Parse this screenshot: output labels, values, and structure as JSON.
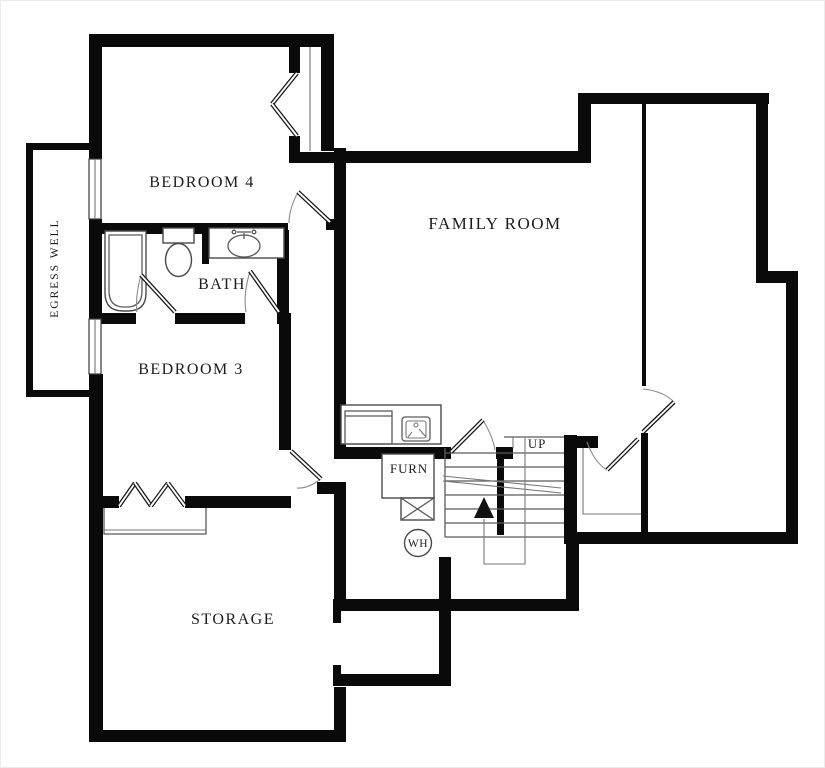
{
  "plan": {
    "type": "basement-floor-plan",
    "colors": {
      "wall": "#0a0a0a",
      "fixture_line": "#4a4a4a",
      "text": "#1c1c1c",
      "background": "#ffffff"
    },
    "rooms": {
      "bedroom4": {
        "label": "BEDROOM 4"
      },
      "bedroom3": {
        "label": "BEDROOM 3"
      },
      "bath": {
        "label": "BATH"
      },
      "family_room": {
        "label": "FAMILY ROOM"
      },
      "storage": {
        "label": "STORAGE"
      },
      "egress_well": {
        "label": "EGRESS WELL"
      }
    },
    "annotations": {
      "furnace": {
        "label": "FURN"
      },
      "water_heater": {
        "label": "WH"
      },
      "stairs_up": {
        "label": "UP"
      }
    },
    "fixtures": [
      "bathtub",
      "toilet",
      "vanity-sink",
      "washer",
      "utility-sink",
      "furnace-box",
      "water-heater-circle",
      "stairs-switchback",
      "closet-bifold-bedroom4",
      "closet-bifold-bedroom3",
      "egress-window-wells"
    ]
  }
}
